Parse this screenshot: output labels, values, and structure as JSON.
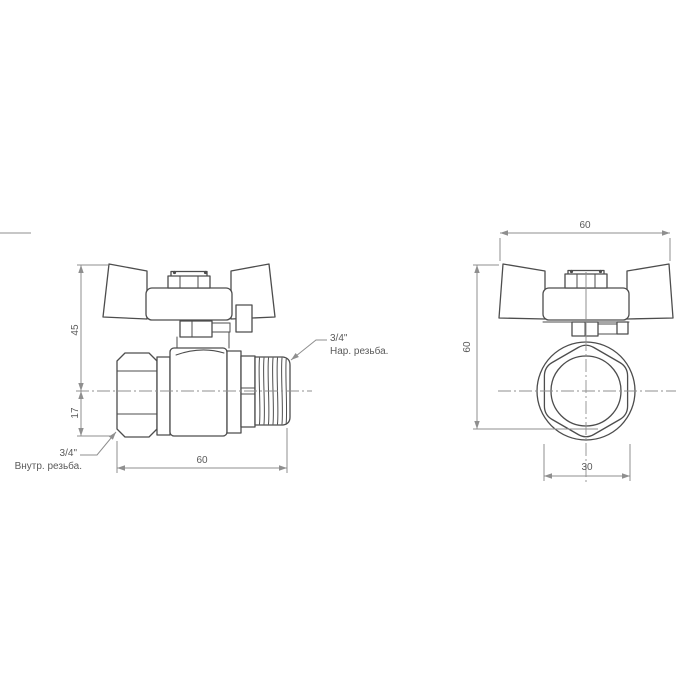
{
  "side_view": {
    "dim_height_upper": "45",
    "dim_height_lower": "17",
    "dim_length": "60",
    "label_male_thread_size": "3/4\"",
    "label_male_thread_text": "Нар. резьба.",
    "label_female_thread_size": "3/4\"",
    "label_female_thread_text": "Внутр. резьба."
  },
  "front_view": {
    "dim_width": "60",
    "dim_height": "60",
    "dim_bottom_width": "30"
  },
  "colors": {
    "background": "#ffffff",
    "object_line": "#4d4d4d",
    "dimension_line": "#8f8f8f",
    "text": "#5a5a5a"
  }
}
